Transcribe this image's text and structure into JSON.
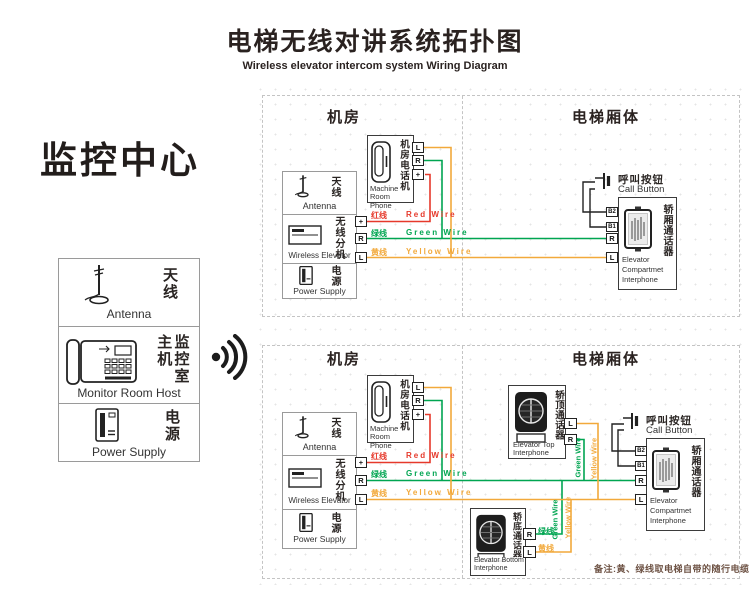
{
  "title": {
    "zh": "电梯无线对讲系统拓扑图",
    "en": "Wireless elevator intercom system Wiring Diagram"
  },
  "monitor_center": {
    "heading": "监控中心",
    "antenna": {
      "zh": "天线",
      "en": "Antenna"
    },
    "host": {
      "zh": "监控室主机",
      "en": "Monitor Room Host"
    },
    "power": {
      "zh": "电源",
      "en": "Power Supply"
    }
  },
  "section_headings": {
    "machine_room": "机房",
    "car_body": "电梯厢体"
  },
  "components": {
    "machine_room_phone": {
      "zh": "机房电话机",
      "en_lines": [
        "Machine",
        "Room Phone"
      ],
      "terminals": [
        "L",
        "R",
        "+"
      ]
    },
    "antenna": {
      "zh": "天线",
      "en": "Antenna"
    },
    "wireless_extension": {
      "zh": "无线分机",
      "en": "Wireless Elevator",
      "terminals": [
        "+",
        "R",
        "L"
      ]
    },
    "power_supply": {
      "zh": "电源",
      "en": "Power Supply"
    },
    "call_button": {
      "zh": "呼叫按钮",
      "en": "Call Button"
    },
    "compartment_interphone": {
      "zh": "轿厢通话器",
      "en_lines": [
        "Elevator",
        "Compartmet",
        "Interphone"
      ],
      "terminals": [
        "B2",
        "B1",
        "R",
        "L"
      ]
    },
    "top_interphone": {
      "zh": "轿顶通话器",
      "en_lines": [
        "Elevator Top",
        "Interphone"
      ],
      "terminals": [
        "L",
        "R"
      ]
    },
    "bottom_interphone": {
      "zh": "轿底通话器",
      "en_lines": [
        "Elevator Bottom",
        "Interphone"
      ],
      "terminals": [
        "R",
        "L"
      ]
    }
  },
  "wires": {
    "red": {
      "zh": "红线",
      "en": "Red Wire",
      "color": "#e6392b"
    },
    "green": {
      "zh": "绿线",
      "en": "Green Wire",
      "color": "#00a551"
    },
    "yellow": {
      "zh": "黄线",
      "en": "Yellow Wire",
      "color": "#f2a93b"
    }
  },
  "note": "备注:黄、绿线取电梯自带的随行电缆"
}
